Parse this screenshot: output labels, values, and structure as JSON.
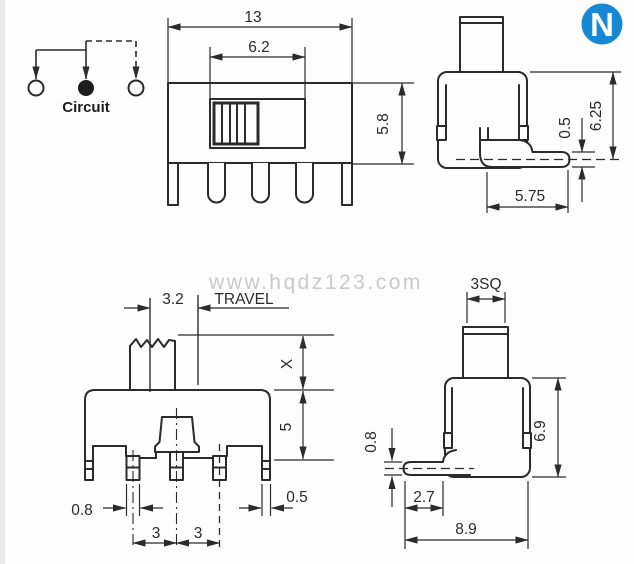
{
  "meta": {
    "background": "#fdfdfd",
    "ink_color": "#2b2b2b",
    "logo_blue": "#1789d4",
    "watermark_color": "#c9c9c9"
  },
  "logo": {
    "letter": "N"
  },
  "watermark": {
    "text": "www.hqdz123.com"
  },
  "circuit": {
    "label": "Circuit"
  },
  "front_top_view": {
    "overall_width": "13",
    "slot_width": "6.2",
    "body_height": "5.8"
  },
  "side_top_view": {
    "pin_thickness": "0.5",
    "height_to_pin": "6.25",
    "pin_length": "5.75"
  },
  "front_bottom_view": {
    "travel_dim": "3.2",
    "travel_label": "TRAVEL",
    "x_dim": "X",
    "body_height": "5",
    "pin_width": "0.8",
    "pitch_left": "3",
    "pitch_right": "3",
    "leg_width": "0.5"
  },
  "side_bottom_view": {
    "actuator_size": "3SQ",
    "pin_thickness": "0.8",
    "body_height": "6.9",
    "pin_offset": "2.7",
    "overall_depth": "8.9"
  }
}
